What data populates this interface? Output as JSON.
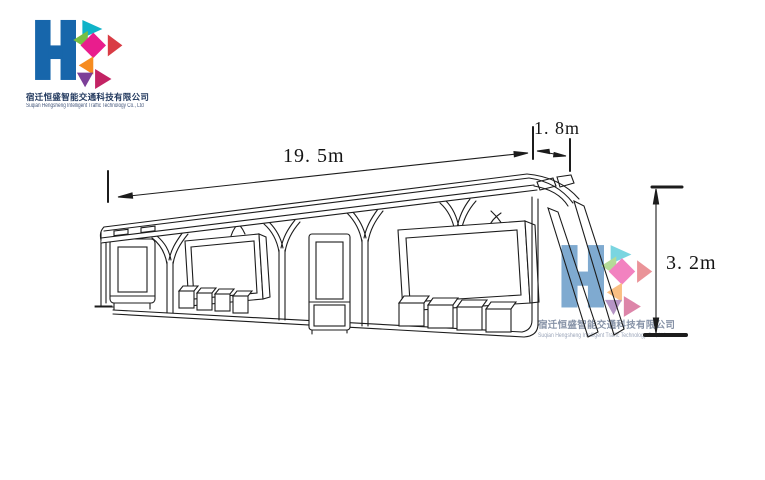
{
  "logo": {
    "monogram": "HS",
    "company_cn": "宿迁恒盛智能交通科技有限公司",
    "company_en": "Suqian Hengsheng Intelligent Traffic Technology Co., Ltd",
    "colors": {
      "h_blue": "#1766ab",
      "teal": "#0fb3c8",
      "green": "#77bf43",
      "magenta": "#e91d8d",
      "red": "#d93c45",
      "orange": "#f68b1f",
      "purple": "#7c3f98",
      "crimson": "#c32364",
      "text_navy": "#22395e"
    }
  },
  "dimensions": {
    "length": "19. 5m",
    "depth": "1. 8m",
    "height": "3. 2m"
  },
  "drawing": {
    "stroke": "#1c1c1c"
  }
}
